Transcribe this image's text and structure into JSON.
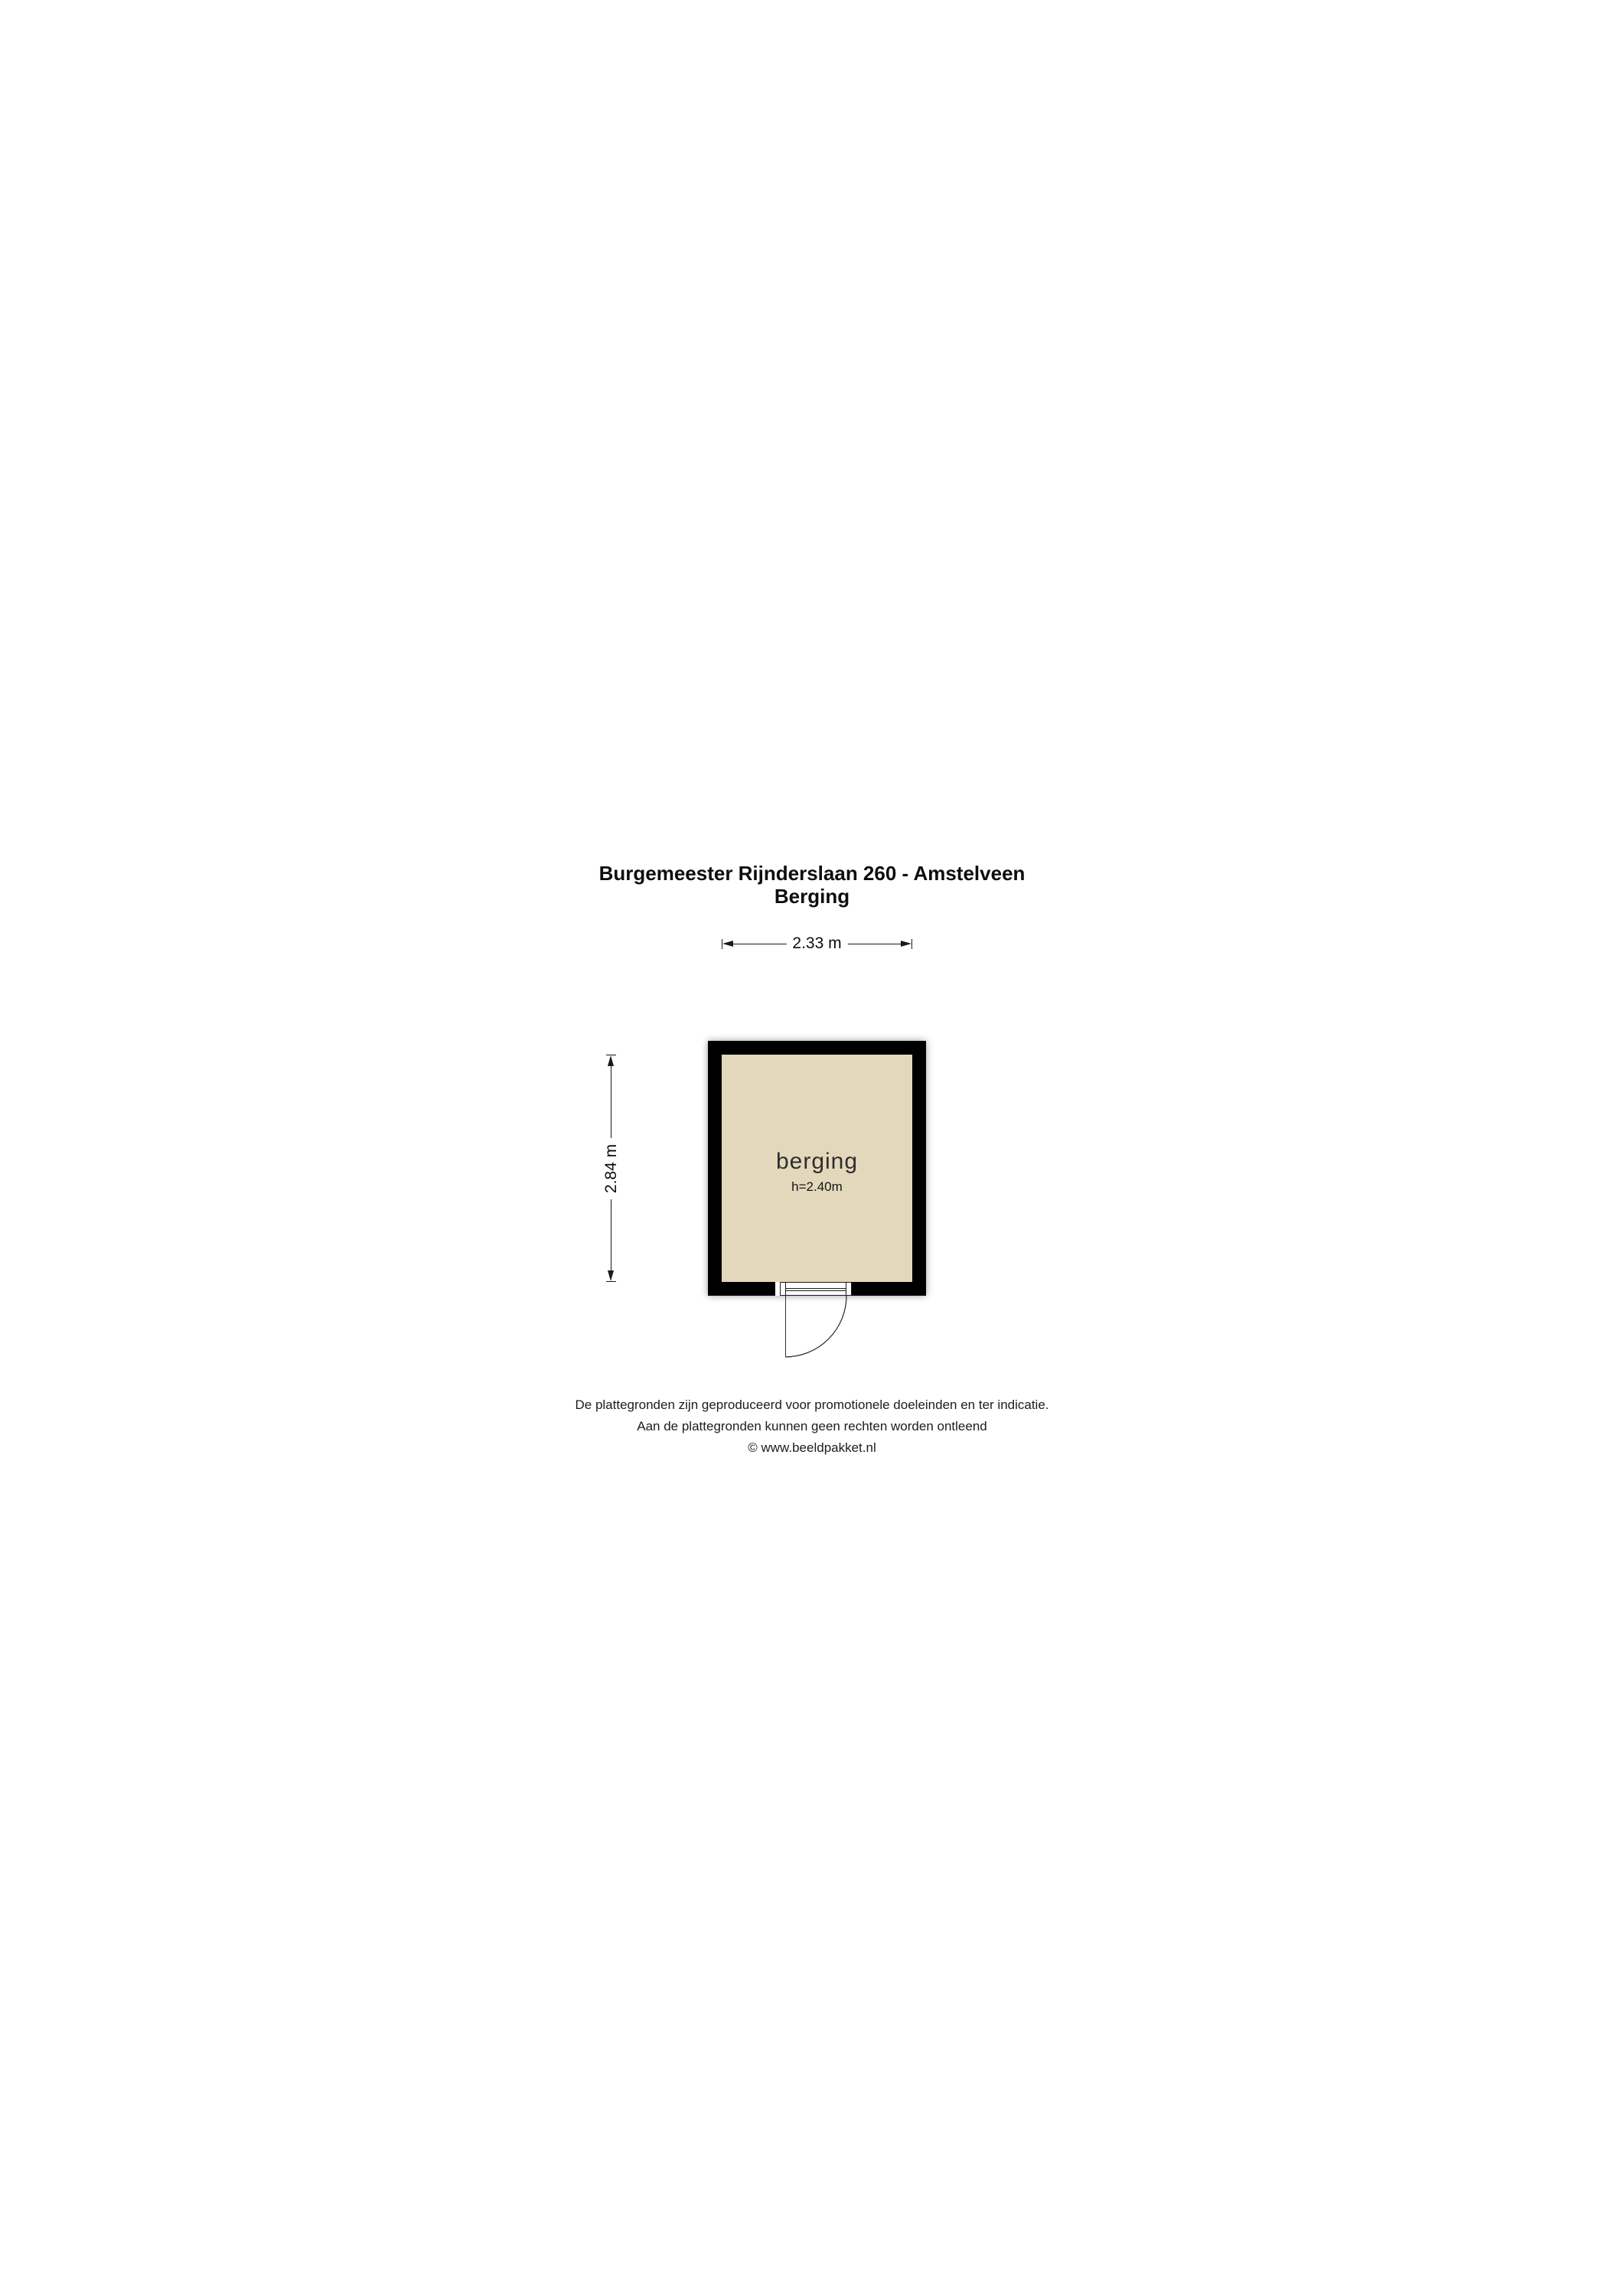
{
  "title": {
    "address": "Burgemeester Rijnderslaan 260 - Amstelveen",
    "subtitle": "Berging"
  },
  "dimensions": {
    "width_label": "2.33 m",
    "height_label": "2.84 m"
  },
  "room": {
    "name": "berging",
    "ceiling_height": "h=2.40m"
  },
  "colors": {
    "wall": "#000000",
    "floor_fill": "#e4d8bc",
    "line": "#1a1a1a",
    "background": "#ffffff"
  },
  "footer": {
    "line1": "De plattegronden zijn geproduceerd voor promotionele doeleinden en ter indicatie.",
    "line2": "Aan de plattegronden kunnen geen rechten worden ontleend",
    "line3": "© www.beeldpakket.nl"
  }
}
